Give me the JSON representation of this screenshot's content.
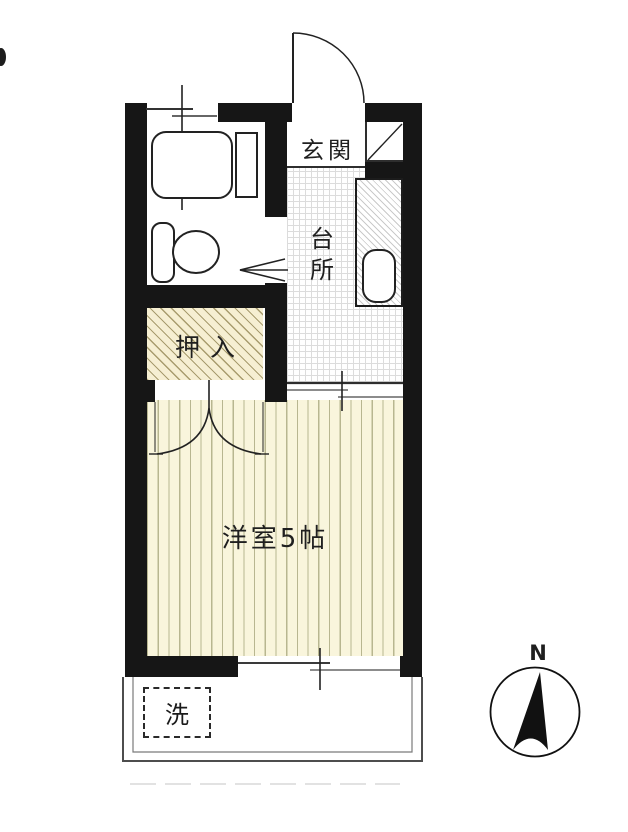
{
  "title": "apartment-floor-plan",
  "rooms": {
    "entrance_label": "玄関",
    "kitchen_label": "台\n所",
    "closet_label": "押入",
    "main_room_label": "洋室5帖",
    "washer_label": "洗"
  },
  "compass": {
    "north_label": "N"
  },
  "fixtures": [
    "bathtub",
    "vanity-shelf",
    "toilet",
    "kitchen-sink",
    "washing-machine",
    "entrance-door",
    "closet-double-door",
    "bathroom-door-arrow",
    "windows",
    "balcony"
  ],
  "colors": {
    "wall": "#161616",
    "tatami_bg": "#f9f5dc",
    "tatami_stripe": "#b8b690",
    "closet_bg": "#f6efd2",
    "closet_hatch": "#a89c6e",
    "kitchen_grid": "#dcdcdc",
    "linework": "#222222",
    "paper": "#ffffff"
  }
}
